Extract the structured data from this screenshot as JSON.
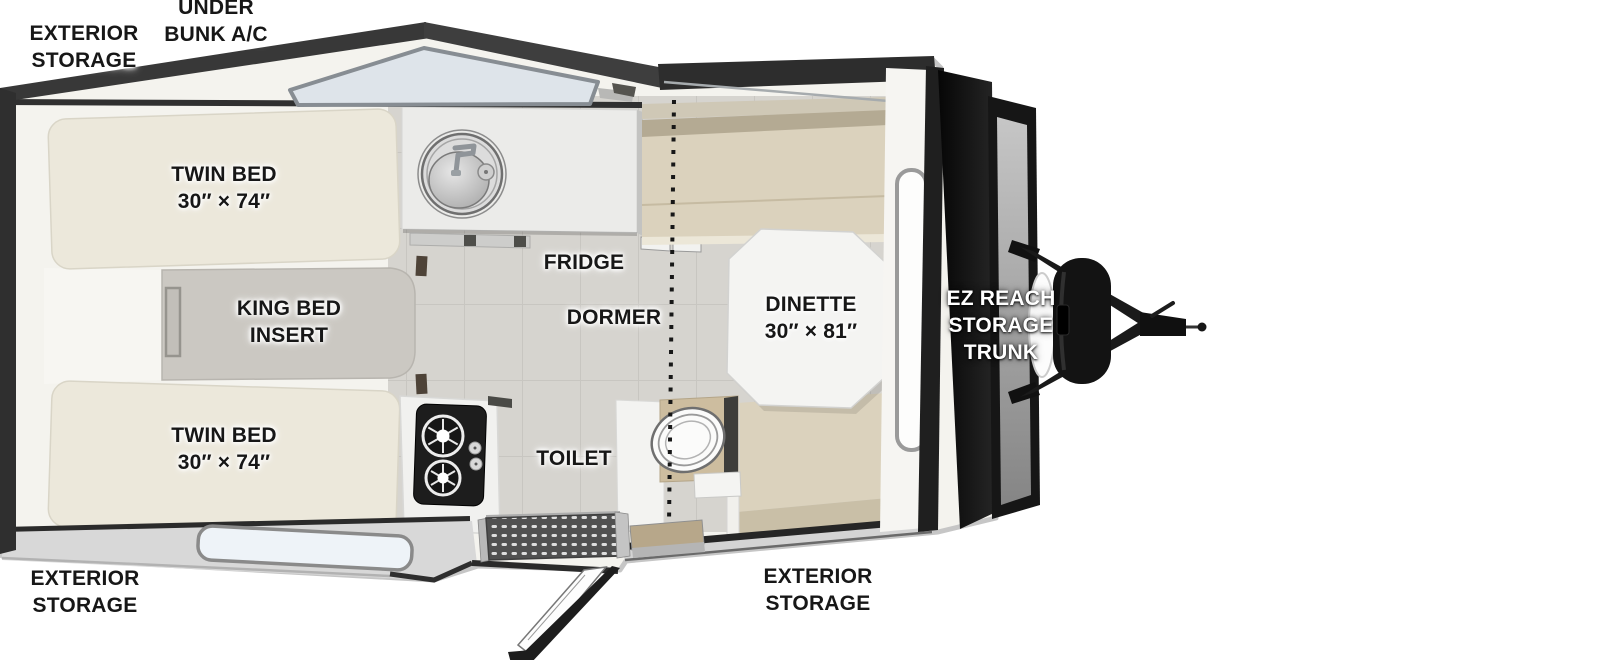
{
  "diagram": {
    "title": "A-frame camper trailer floor plan (top view)",
    "labels": {
      "exterior_storage_top": {
        "line1": "EXTERIOR",
        "line2": "STORAGE"
      },
      "under_bunk_ac": {
        "line1": "UNDER",
        "line2": "BUNK A/C"
      },
      "twin_bed_top": {
        "line1": "TWIN BED",
        "line2": "30″ × 74″"
      },
      "king_bed_insert": {
        "line1": "KING BED",
        "line2": "INSERT"
      },
      "twin_bed_bottom": {
        "line1": "TWIN BED",
        "line2": "30″ × 74″"
      },
      "exterior_storage_rear": {
        "line1": "EXTERIOR",
        "line2": "STORAGE"
      },
      "fridge": {
        "text": "FRIDGE"
      },
      "dormer": {
        "text": "DORMER"
      },
      "dinette": {
        "line1": "DINETTE",
        "line2": "30″ × 81″"
      },
      "toilet": {
        "text": "TOILET"
      },
      "ez_reach_trunk": {
        "line1": "EZ REACH",
        "line2": "STORAGE",
        "line3": "TRUNK"
      },
      "exterior_storage_door": {
        "line1": "EXTERIOR",
        "line2": "STORAGE"
      }
    },
    "colors": {
      "background": "#ffffff",
      "outline_dark": "#2f2f2f",
      "body_white": "#f4f3ee",
      "floor_tile": "#d6d4cf",
      "bench_tan": "#dbd2bd",
      "bench_back_tan": "#b4aa93",
      "bed_cream": "#ece8db",
      "king_insert_gray": "#cbc8c2",
      "skylight_glass": "#dee4ea",
      "window_glass": "#eef3f8",
      "trunk_black": "#131313",
      "label_dark": "#171717",
      "label_light": "#ffffff"
    }
  }
}
